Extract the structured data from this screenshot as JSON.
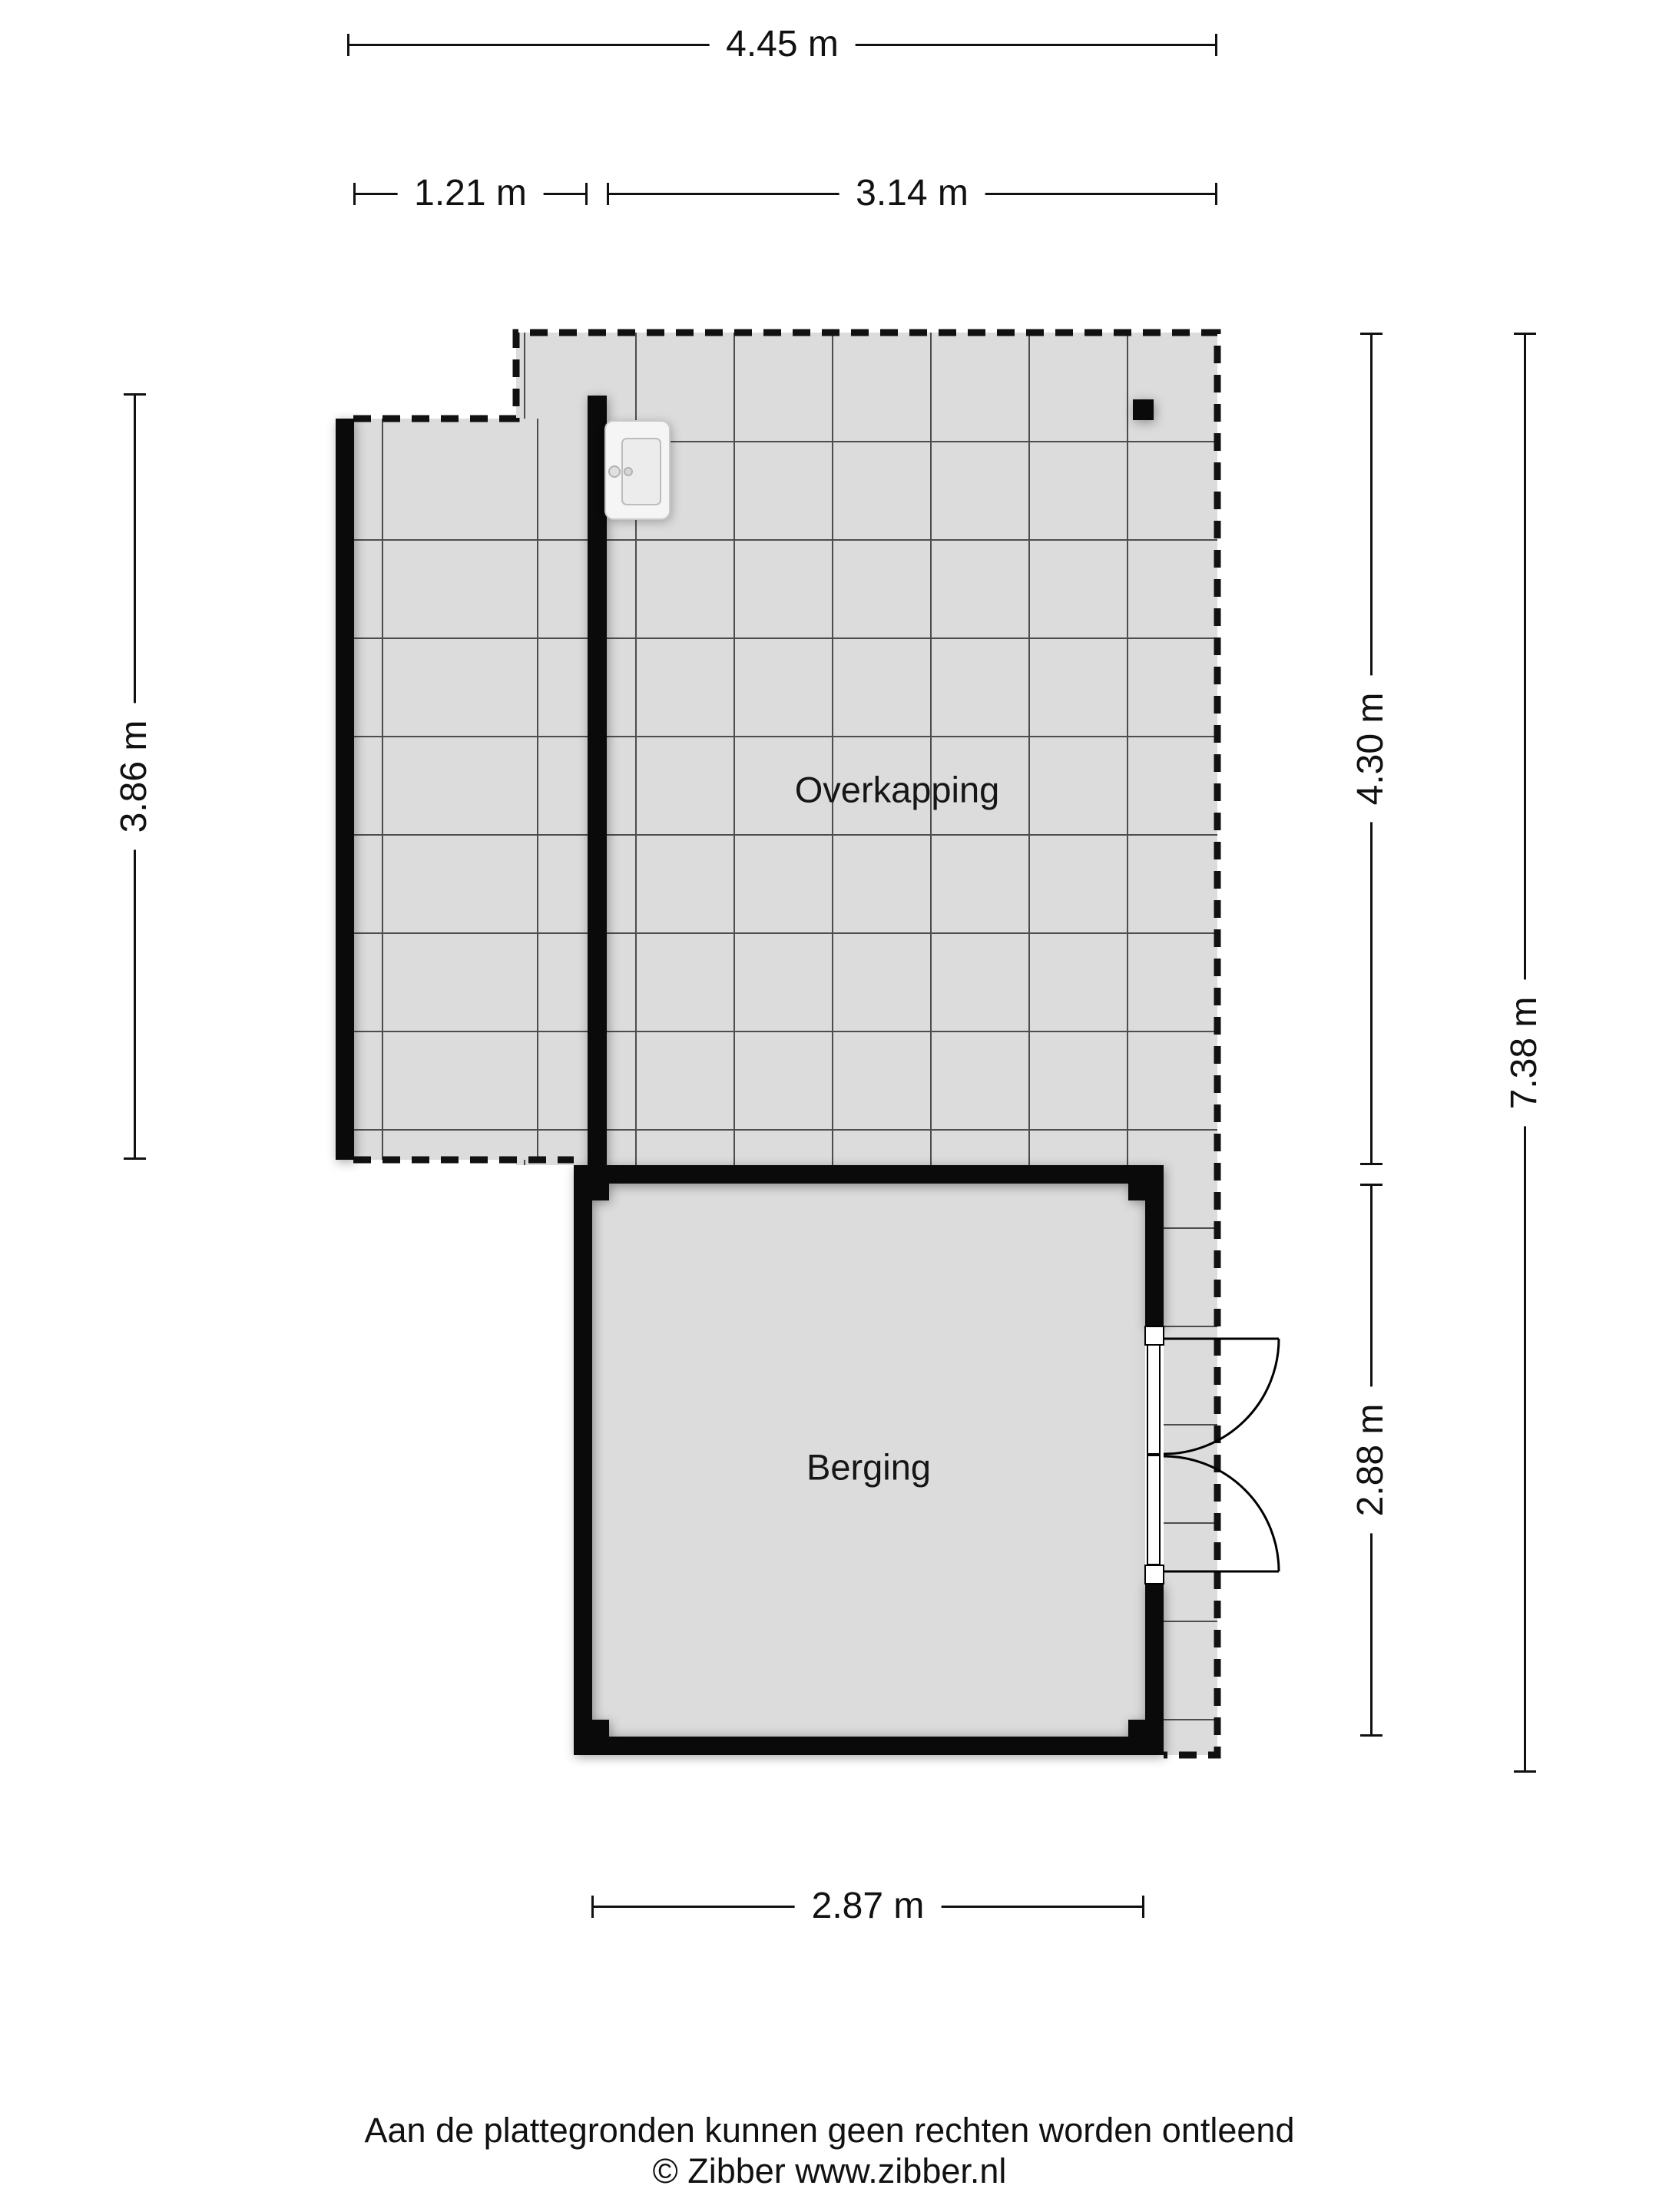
{
  "floorplan": {
    "rooms": [
      {
        "name": "Overkapping",
        "floor": "tiled"
      },
      {
        "name": "Berging",
        "floor": "plain"
      }
    ],
    "dimensions": {
      "top_total": "4.45 m",
      "top_left_segment": "1.21 m",
      "top_right_segment": "3.14 m",
      "left_height": "3.86 m",
      "right_upper": "4.30 m",
      "right_lower": "2.88 m",
      "right_total": "7.38 m",
      "bottom_width": "2.87 m"
    },
    "fixtures": {
      "sink": "sink-basin",
      "post": "square-post",
      "doors": "double-swing-doors"
    },
    "colors": {
      "background": "#ffffff",
      "floor_fill": "#dcdcdc",
      "grid_line": "#4d4d4d",
      "wall": "#0a0a0a"
    }
  },
  "footer": {
    "disclaimer": "Aan de plattegronden kunnen geen rechten worden ontleend",
    "copyright": "© Zibber www.zibber.nl"
  }
}
